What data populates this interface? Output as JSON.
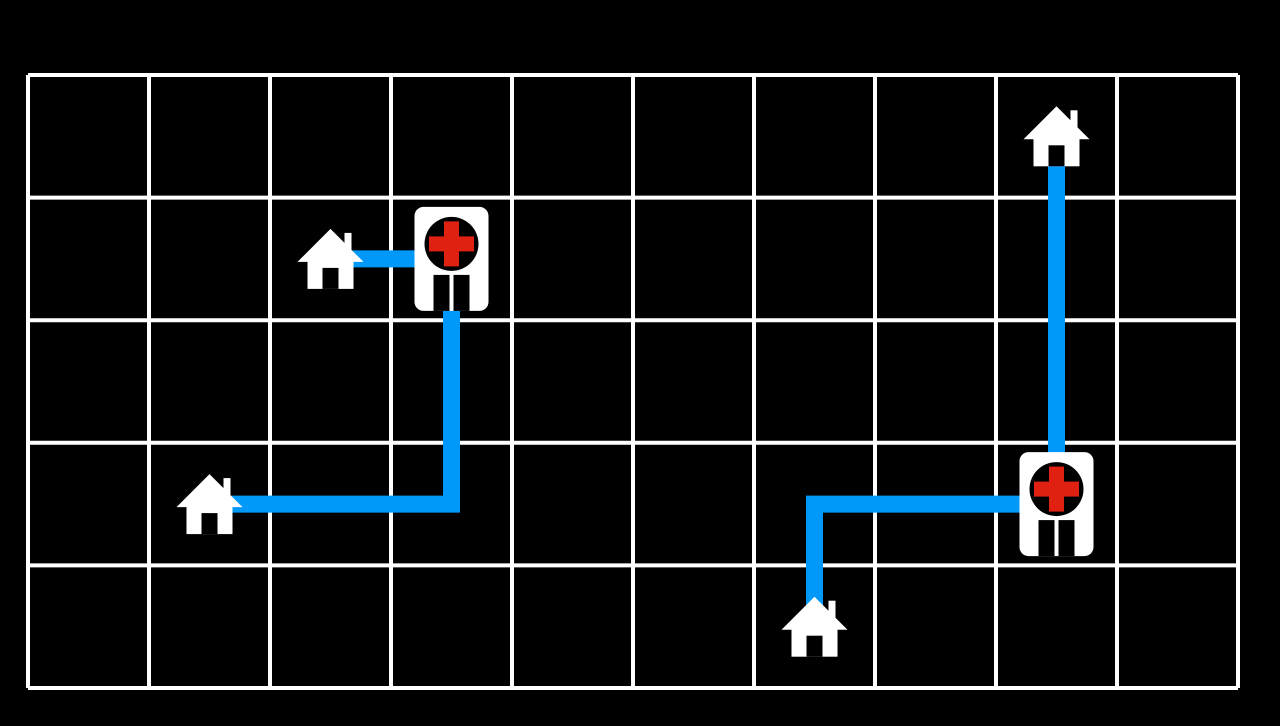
{
  "hud": {
    "cost_text": "Cost: 11",
    "cost_value": 11
  },
  "colors": {
    "background": "#000000",
    "grid_line": "#ffffff",
    "path_blue": "#0099fa",
    "building_white": "#ffffff",
    "building_black": "#000000",
    "cross_red": "#e02112"
  },
  "board": {
    "columns": 10,
    "rows": 5,
    "origin_x": 28,
    "origin_y": 75,
    "cell_width": 121,
    "cell_height": 122.6,
    "grid_line_thickness": 4,
    "path_thickness": 17
  },
  "entities": {
    "houses": [
      {
        "id": "house-top-right",
        "col": 8,
        "row": 0
      },
      {
        "id": "house-upper-left",
        "col": 2,
        "row": 1
      },
      {
        "id": "house-lower-left",
        "col": 1,
        "row": 3
      },
      {
        "id": "house-bottom-mid",
        "col": 6,
        "row": 4
      }
    ],
    "hospitals": [
      {
        "id": "hospital-upper-left",
        "col": 3,
        "row": 1
      },
      {
        "id": "hospital-right",
        "col": 8,
        "row": 3
      }
    ]
  },
  "paths": [
    {
      "from": "house-upper-left",
      "to": "hospital-upper-left",
      "cells": [
        [
          2,
          1
        ],
        [
          3,
          1
        ]
      ]
    },
    {
      "from": "house-lower-left",
      "to": "hospital-upper-left",
      "cells": [
        [
          1,
          3
        ],
        [
          3,
          3
        ],
        [
          3,
          1
        ]
      ]
    },
    {
      "from": "house-bottom-mid",
      "to": "hospital-right",
      "cells": [
        [
          6,
          4
        ],
        [
          6,
          3
        ],
        [
          8,
          3
        ]
      ]
    },
    {
      "from": "house-top-right",
      "to": "hospital-right",
      "cells": [
        [
          8,
          0
        ],
        [
          8,
          3
        ]
      ]
    }
  ]
}
